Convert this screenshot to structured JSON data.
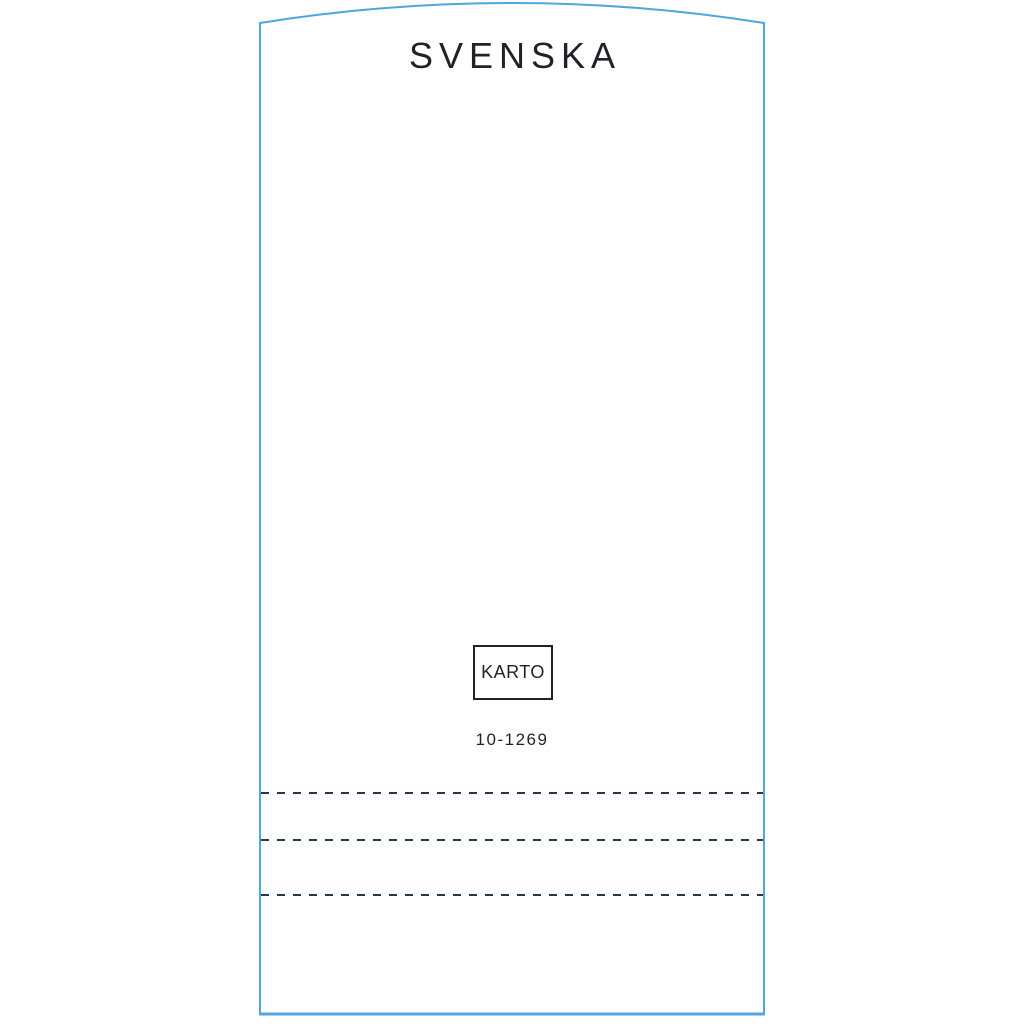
{
  "dieline": {
    "brand_title": "SVENSKA",
    "logo_label": "KARTO",
    "item_code": "10-1269"
  },
  "colors": {
    "cut_line_blue": "#4FA5DC",
    "perforation_navy": "#1E3A55",
    "ink_black": "#1F2328",
    "background": "#FFFFFF"
  }
}
